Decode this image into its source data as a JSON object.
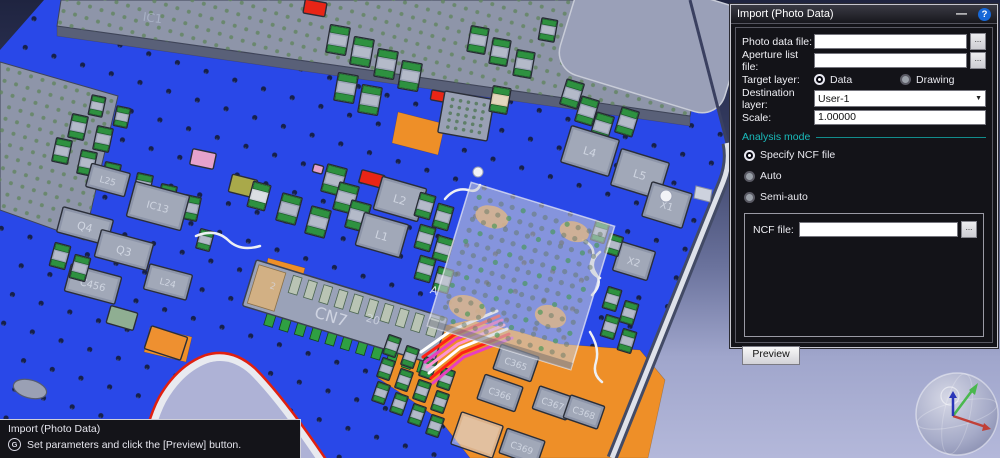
{
  "dialog": {
    "title": "Import (Photo Data)",
    "minimize_glyph": "—",
    "help_glyph": "?",
    "browse_label": "...",
    "fields": {
      "photo": {
        "label": "Photo data file:",
        "value": ""
      },
      "aperture": {
        "label": "Aperture list file:",
        "value": ""
      },
      "target_layer": {
        "label": "Target layer:",
        "options": [
          {
            "label": "Data",
            "selected": true
          },
          {
            "label": "Drawing",
            "selected": false
          }
        ]
      },
      "destination_layer": {
        "label": "Destination layer:",
        "value": "User-1"
      },
      "scale": {
        "label": "Scale:",
        "value": "1.00000"
      }
    },
    "analysis_mode": {
      "label": "Analysis mode",
      "options": [
        {
          "label": "Specify NCF file",
          "selected": true
        },
        {
          "label": "Auto",
          "selected": false
        },
        {
          "label": "Semi-auto",
          "selected": false
        }
      ]
    },
    "ncf": {
      "label": "NCF file:",
      "value": ""
    },
    "preview_button": "Preview",
    "accent_teal": "#19bcbc",
    "help_blue": "#1668d8"
  },
  "status_overlay": {
    "title": "Import (Photo Data)",
    "icon_glyph": "G",
    "message": "Set parameters and click the [Preview] button."
  },
  "pcb": {
    "board_color": "#2948e8",
    "copper_color": "#ee8f28",
    "silk_color": "#e8eaf2",
    "components": [
      {
        "k": "poly",
        "pts": "57,26 690,116 690,126 57,36",
        "c": "#596078"
      },
      {
        "k": "slab",
        "pts": "57,26 250,53 690,116 700,60 696,0 61,0"
      },
      {
        "k": "slab",
        "pts": "0,62 118,96 84,240 0,210"
      },
      {
        "k": "rslab",
        "x": 652,
        "y": 40,
        "w": 172,
        "h": 112,
        "r": 17,
        "rx": 24
      },
      {
        "k": "poly",
        "pts": "398,112 445,124 438,155 392,143",
        "c": "#ee8f28"
      },
      {
        "k": "poly",
        "pts": "268,258 305,268 298,296 262,286",
        "c": "#ee8f28"
      },
      {
        "k": "poly",
        "pts": "150,327 192,337 186,362 144,352",
        "c": "#ee8f28"
      },
      {
        "k": "poly",
        "pts": "398,336 470,320 520,332 560,344 640,350 665,380 648,458 470,458 440,420 408,398 378,378",
        "c": "#ee8f28"
      },
      {
        "k": "cap",
        "x": 78,
        "y": 127,
        "r": 12,
        "w": 16,
        "h": 24
      },
      {
        "k": "cap",
        "x": 103,
        "y": 139,
        "r": 12,
        "w": 16,
        "h": 24
      },
      {
        "k": "cap",
        "x": 62,
        "y": 151,
        "r": 12,
        "w": 16,
        "h": 24
      },
      {
        "k": "cap",
        "x": 87,
        "y": 163,
        "r": 12,
        "w": 16,
        "h": 24
      },
      {
        "k": "cap",
        "x": 111,
        "y": 175,
        "r": 12,
        "w": 16,
        "h": 24
      },
      {
        "k": "cap",
        "x": 143,
        "y": 186,
        "r": 12,
        "w": 16,
        "h": 24
      },
      {
        "k": "cap",
        "x": 167,
        "y": 197,
        "r": 12,
        "w": 16,
        "h": 24
      },
      {
        "k": "cap",
        "x": 191,
        "y": 208,
        "r": 12,
        "w": 16,
        "h": 24
      },
      {
        "k": "cap",
        "x": 97,
        "y": 106,
        "r": 12,
        "w": 14,
        "h": 20
      },
      {
        "k": "cap",
        "x": 122,
        "y": 117,
        "r": 12,
        "w": 14,
        "h": 20
      },
      {
        "k": "chip",
        "x": 203,
        "y": 159,
        "r": 12,
        "w": 24,
        "h": 16,
        "c": "pink"
      },
      {
        "k": "chip",
        "x": 243,
        "y": 186,
        "r": 14,
        "w": 26,
        "h": 18,
        "c": "olive"
      },
      {
        "k": "cap",
        "x": 259,
        "y": 196,
        "r": 15,
        "w": 18,
        "h": 26,
        "c": "light"
      },
      {
        "k": "cap",
        "x": 289,
        "y": 209,
        "r": 15,
        "w": 20,
        "h": 28
      },
      {
        "k": "cap",
        "x": 318,
        "y": 222,
        "r": 15,
        "w": 20,
        "h": 28
      },
      {
        "k": "cap",
        "x": 334,
        "y": 180,
        "r": 15,
        "w": 20,
        "h": 28
      },
      {
        "k": "cap",
        "x": 346,
        "y": 198,
        "r": 15,
        "w": 20,
        "h": 28
      },
      {
        "k": "cap",
        "x": 358,
        "y": 216,
        "r": 15,
        "w": 20,
        "h": 28
      },
      {
        "k": "cap",
        "x": 371,
        "y": 234,
        "r": 15,
        "w": 20,
        "h": 28
      },
      {
        "k": "chip",
        "x": 372,
        "y": 179,
        "r": 15,
        "w": 24,
        "h": 13,
        "c": "red"
      },
      {
        "k": "chip",
        "x": 318,
        "y": 169,
        "r": 15,
        "w": 10,
        "h": 8,
        "c": "pink"
      },
      {
        "k": "chip",
        "x": 400,
        "y": 199,
        "r": 16,
        "w": 46,
        "h": 34,
        "lbl": "L2",
        "fs": 11
      },
      {
        "k": "chip",
        "x": 382,
        "y": 235,
        "r": 16,
        "w": 46,
        "h": 34,
        "lbl": "L1",
        "fs": 11
      },
      {
        "k": "cap",
        "x": 425,
        "y": 206,
        "r": 16,
        "w": 16,
        "h": 24
      },
      {
        "k": "cap",
        "x": 443,
        "y": 217,
        "r": 16,
        "w": 16,
        "h": 24
      },
      {
        "k": "cap",
        "x": 425,
        "y": 238,
        "r": 16,
        "w": 16,
        "h": 24
      },
      {
        "k": "cap",
        "x": 443,
        "y": 249,
        "r": 16,
        "w": 16,
        "h": 24
      },
      {
        "k": "cap",
        "x": 425,
        "y": 269,
        "r": 16,
        "w": 16,
        "h": 24
      },
      {
        "k": "cap",
        "x": 443,
        "y": 280,
        "r": 16,
        "w": 16,
        "h": 24
      },
      {
        "k": "cap",
        "x": 338,
        "y": 40,
        "r": 10,
        "w": 20,
        "h": 28
      },
      {
        "k": "cap",
        "x": 362,
        "y": 52,
        "r": 10,
        "w": 20,
        "h": 28
      },
      {
        "k": "cap",
        "x": 386,
        "y": 64,
        "r": 10,
        "w": 20,
        "h": 28
      },
      {
        "k": "cap",
        "x": 410,
        "y": 76,
        "r": 10,
        "w": 20,
        "h": 28
      },
      {
        "k": "cap",
        "x": 346,
        "y": 88,
        "r": 10,
        "w": 20,
        "h": 28
      },
      {
        "k": "cap",
        "x": 370,
        "y": 100,
        "r": 10,
        "w": 20,
        "h": 28
      },
      {
        "k": "chip",
        "x": 315,
        "y": 8,
        "r": 10,
        "w": 22,
        "h": 14,
        "c": "red"
      },
      {
        "k": "chip",
        "x": 438,
        "y": 96,
        "r": 10,
        "w": 14,
        "h": 10,
        "c": "red"
      },
      {
        "k": "minibga",
        "x": 466,
        "y": 116,
        "r": 10,
        "w": 50,
        "h": 42
      },
      {
        "k": "cap",
        "x": 500,
        "y": 100,
        "r": 10,
        "w": 18,
        "h": 26,
        "c": "beige"
      },
      {
        "k": "cap",
        "x": 478,
        "y": 40,
        "r": 10,
        "w": 18,
        "h": 26
      },
      {
        "k": "cap",
        "x": 500,
        "y": 52,
        "r": 10,
        "w": 18,
        "h": 26
      },
      {
        "k": "cap",
        "x": 524,
        "y": 64,
        "r": 10,
        "w": 18,
        "h": 26
      },
      {
        "k": "cap",
        "x": 548,
        "y": 30,
        "r": 10,
        "w": 16,
        "h": 22
      },
      {
        "k": "cap",
        "x": 572,
        "y": 94,
        "r": 17,
        "w": 18,
        "h": 26
      },
      {
        "k": "cap",
        "x": 587,
        "y": 111,
        "r": 17,
        "w": 18,
        "h": 26
      },
      {
        "k": "cap",
        "x": 602,
        "y": 127,
        "r": 17,
        "w": 18,
        "h": 26
      },
      {
        "k": "cap",
        "x": 627,
        "y": 122,
        "r": 17,
        "w": 18,
        "h": 26
      },
      {
        "k": "chip",
        "x": 590,
        "y": 151,
        "r": 17,
        "w": 50,
        "h": 38,
        "lbl": "L4",
        "fs": 11
      },
      {
        "k": "chip",
        "x": 640,
        "y": 174,
        "r": 17,
        "w": 50,
        "h": 38,
        "lbl": "L5",
        "fs": 11
      },
      {
        "k": "chip",
        "x": 667,
        "y": 205,
        "r": 17,
        "w": 42,
        "h": 36,
        "lbl": "X1",
        "fs": 10
      },
      {
        "k": "chip",
        "x": 634,
        "y": 261,
        "r": 17,
        "w": 36,
        "h": 30,
        "lbl": "X2",
        "fs": 10
      },
      {
        "k": "cap",
        "x": 612,
        "y": 299,
        "r": 17,
        "w": 14,
        "h": 22
      },
      {
        "k": "cap",
        "x": 629,
        "y": 313,
        "r": 17,
        "w": 14,
        "h": 22
      },
      {
        "k": "cap",
        "x": 610,
        "y": 327,
        "r": 17,
        "w": 14,
        "h": 22
      },
      {
        "k": "cap",
        "x": 627,
        "y": 341,
        "r": 17,
        "w": 14,
        "h": 22
      },
      {
        "k": "cap",
        "x": 600,
        "y": 232,
        "r": 17,
        "w": 14,
        "h": 20
      },
      {
        "k": "cap",
        "x": 614,
        "y": 245,
        "r": 17,
        "w": 14,
        "h": 20
      },
      {
        "k": "chip",
        "x": 108,
        "y": 180,
        "r": 15,
        "w": 40,
        "h": 24,
        "lbl": "L25",
        "fs": 9
      },
      {
        "k": "chip",
        "x": 85,
        "y": 226,
        "r": 15,
        "w": 52,
        "h": 26,
        "lbl": "Q4",
        "fs": 11
      },
      {
        "k": "chip",
        "x": 124,
        "y": 250,
        "r": 15,
        "w": 54,
        "h": 28,
        "lbl": "Q3",
        "fs": 11
      },
      {
        "k": "chip",
        "x": 158,
        "y": 206,
        "r": 15,
        "w": 56,
        "h": 36,
        "lbl": "IC13",
        "fs": 10
      },
      {
        "k": "chip",
        "x": 93,
        "y": 284,
        "r": 15,
        "w": 52,
        "h": 28,
        "lbl": "C456",
        "fs": 10
      },
      {
        "k": "chip",
        "x": 168,
        "y": 282,
        "r": 15,
        "w": 44,
        "h": 26,
        "lbl": "L24",
        "fs": 9
      },
      {
        "k": "cap",
        "x": 60,
        "y": 256,
        "r": 15,
        "w": 16,
        "h": 24
      },
      {
        "k": "cap",
        "x": 80,
        "y": 268,
        "r": 15,
        "w": 16,
        "h": 24
      },
      {
        "k": "cap",
        "x": 205,
        "y": 240,
        "r": 15,
        "w": 14,
        "h": 20
      },
      {
        "k": "chip",
        "x": 122,
        "y": 318,
        "r": 16,
        "w": 28,
        "h": 18,
        "c": "greenish"
      },
      {
        "k": "chip",
        "x": 166,
        "y": 343,
        "r": 18,
        "w": 38,
        "h": 24,
        "c": "orange"
      },
      {
        "k": "oval",
        "x": 30,
        "y": 389,
        "rx": 17,
        "ry": 9,
        "r": 15
      },
      {
        "k": "trace",
        "d": "M196,236 Q215,228 228,240 Q240,252 260,246",
        "c": "#eef0f4",
        "w": 2.5
      },
      {
        "k": "trace",
        "d": "M445,199 Q455,187 468,190 Q477,193 480,185",
        "c": "#eef0f4",
        "w": 2.5
      },
      {
        "k": "trace",
        "d": "M583,240 Q597,247 592,260 Q587,272 600,278",
        "c": "#eef0f4",
        "w": 2.5
      },
      {
        "k": "trace",
        "d": "M600,252 Q588,262 596,274 Q603,284 592,295",
        "c": "#eef0f4",
        "w": 2.5
      },
      {
        "k": "trace",
        "d": "M590,332 Q600,348 596,362 Q592,374 602,382",
        "c": "#eef0f4",
        "w": 2.5
      },
      {
        "k": "conn",
        "x": 345,
        "y": 312,
        "w": 200,
        "h": 48,
        "r": 17,
        "lbl": "CN7"
      },
      {
        "k": "cap",
        "x": 392,
        "y": 346,
        "r": 19,
        "w": 13,
        "h": 20
      },
      {
        "k": "cap",
        "x": 410,
        "y": 357,
        "r": 19,
        "w": 13,
        "h": 20
      },
      {
        "k": "cap",
        "x": 428,
        "y": 368,
        "r": 19,
        "w": 13,
        "h": 20
      },
      {
        "k": "cap",
        "x": 446,
        "y": 379,
        "r": 19,
        "w": 13,
        "h": 20
      },
      {
        "k": "cap",
        "x": 386,
        "y": 369,
        "r": 19,
        "w": 13,
        "h": 20
      },
      {
        "k": "cap",
        "x": 404,
        "y": 380,
        "r": 19,
        "w": 13,
        "h": 20
      },
      {
        "k": "cap",
        "x": 422,
        "y": 391,
        "r": 19,
        "w": 13,
        "h": 20
      },
      {
        "k": "cap",
        "x": 440,
        "y": 402,
        "r": 19,
        "w": 13,
        "h": 20
      },
      {
        "k": "cap",
        "x": 381,
        "y": 393,
        "r": 19,
        "w": 13,
        "h": 20
      },
      {
        "k": "cap",
        "x": 399,
        "y": 404,
        "r": 19,
        "w": 13,
        "h": 20
      },
      {
        "k": "cap",
        "x": 417,
        "y": 415,
        "r": 19,
        "w": 13,
        "h": 20
      },
      {
        "k": "cap",
        "x": 435,
        "y": 426,
        "r": 19,
        "w": 13,
        "h": 20
      },
      {
        "k": "pad",
        "x": 448,
        "y": 326,
        "r": 19,
        "w": 8,
        "h": 14
      },
      {
        "k": "pad",
        "x": 463,
        "y": 332,
        "r": 19,
        "w": 8,
        "h": 14
      },
      {
        "k": "pad",
        "x": 479,
        "y": 338,
        "r": 19,
        "w": 8,
        "h": 14
      },
      {
        "k": "pad",
        "x": 495,
        "y": 344,
        "r": 19,
        "w": 8,
        "h": 14
      },
      {
        "k": "chip",
        "x": 516,
        "y": 363,
        "r": 19,
        "w": 40,
        "h": 26,
        "lbl": "C365",
        "fs": 9
      },
      {
        "k": "chip",
        "x": 500,
        "y": 393,
        "r": 19,
        "w": 40,
        "h": 26,
        "lbl": "C366",
        "fs": 9
      },
      {
        "k": "chip",
        "x": 553,
        "y": 403,
        "r": 19,
        "w": 36,
        "h": 24,
        "lbl": "C367",
        "fs": 9
      },
      {
        "k": "chip",
        "x": 584,
        "y": 412,
        "r": 19,
        "w": 36,
        "h": 24,
        "lbl": "C368",
        "fs": 9
      },
      {
        "k": "chip",
        "x": 522,
        "y": 447,
        "r": 19,
        "w": 40,
        "h": 26,
        "lbl": "C369",
        "fs": 9
      },
      {
        "k": "chip",
        "x": 477,
        "y": 435,
        "r": 19,
        "w": 44,
        "h": 34,
        "c": "ghost"
      },
      {
        "k": "trace",
        "d": "M497,311 L452,330 L421,352",
        "c": "#ffffff",
        "w": 3
      },
      {
        "k": "trace",
        "d": "M499,316 L454,335 L423,357",
        "c": "#ff2015",
        "w": 3
      },
      {
        "k": "trace",
        "d": "M502,320 L456,339 L425,362",
        "c": "#e83fc0",
        "w": 3
      },
      {
        "k": "trace",
        "d": "M504,325 L458,344 L427,367",
        "c": "#ff93d2",
        "w": 3
      },
      {
        "k": "trace",
        "d": "M507,329 L460,348 L429,373",
        "c": "#ffffff",
        "w": 3
      },
      {
        "k": "trace",
        "d": "M509,334 L462,353 L431,378",
        "c": "#ff2015",
        "w": 3
      },
      {
        "k": "trace",
        "d": "M512,338 L464,357 L433,383",
        "c": "#e83fc0",
        "w": 3
      },
      {
        "k": "bga",
        "x": 521,
        "y": 276,
        "size": 150,
        "r": 17
      },
      {
        "k": "hole",
        "x": 478,
        "y": 172,
        "rad": 5
      },
      {
        "k": "hole",
        "x": 666,
        "y": 196,
        "rad": 6
      },
      {
        "k": "label",
        "x": 152,
        "y": 22,
        "r": 8,
        "t": "IC1",
        "fs": 12,
        "c": "rgba(200,210,230,0.45)"
      },
      {
        "k": "label",
        "x": 272,
        "y": 289,
        "r": 17,
        "t": "2",
        "fs": 9,
        "c": "rgba(215,220,232,0.7)"
      },
      {
        "k": "label",
        "x": 372,
        "y": 323,
        "r": 17,
        "t": "20",
        "fs": 11,
        "c": "rgba(215,220,232,0.75)"
      },
      {
        "k": "label",
        "x": 433,
        "y": 294,
        "r": 17,
        "t": "A",
        "fs": 11,
        "c": "rgba(235,238,246,0.9)"
      }
    ]
  }
}
